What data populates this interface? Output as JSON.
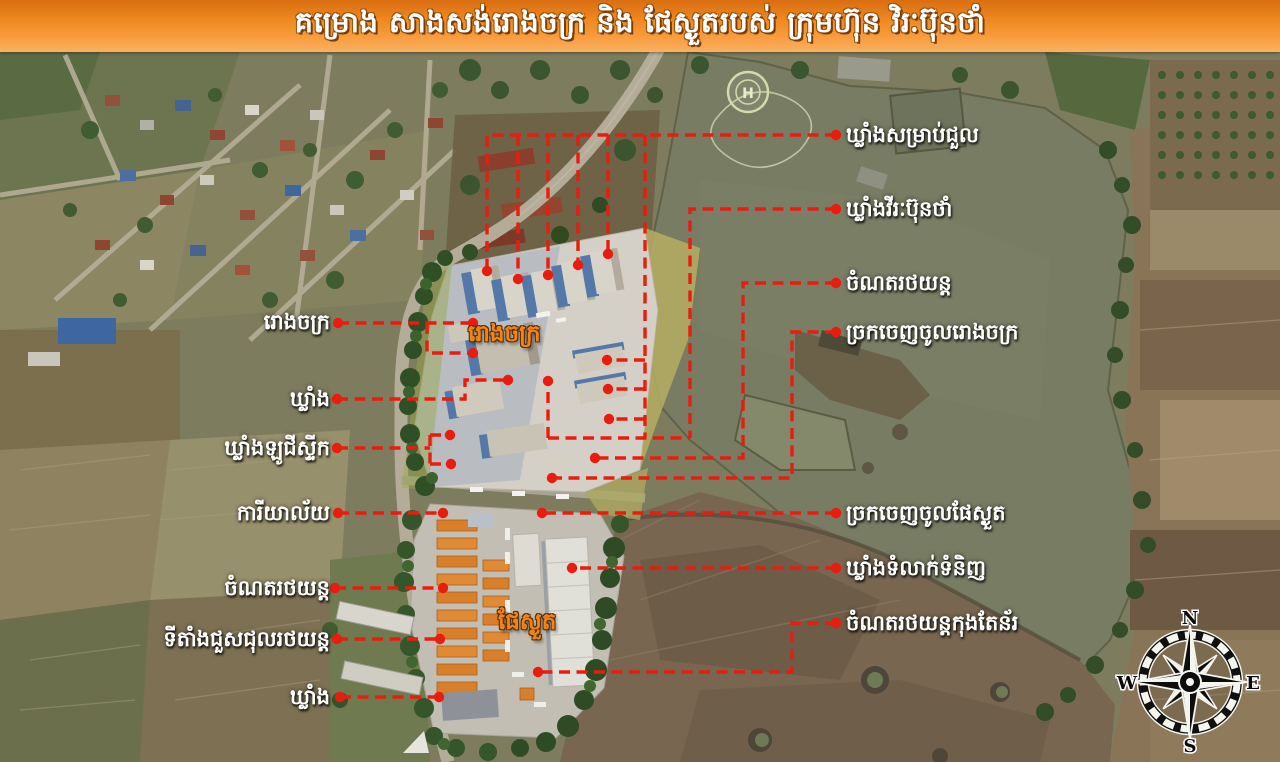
{
  "header": {
    "title": "គម្រោង សាងសង់រោងចក្រ និង ផែស្ងួតរបស់ ក្រុមហ៊ុន វិរៈប៊ុនថាំ"
  },
  "labels": {
    "right": [
      {
        "text": "ឃ្លាំងសម្រាប់ជួល"
      },
      {
        "text": "ឃ្លាំងវីរៈប៊ុនថាំ"
      },
      {
        "text": "ចំណតរថយន្ត"
      },
      {
        "text": "ច្រកចេញចូលរោងចក្រ"
      },
      {
        "text": "ច្រកចេញចូលផែស្ងួត"
      },
      {
        "text": "ឃ្លាំងទំលាក់ទំនិញ"
      },
      {
        "text": "ចំណតរថយន្តកុងតែន័រ"
      }
    ],
    "left": [
      {
        "text": "រោងចក្រ"
      },
      {
        "text": "ឃ្លាំង"
      },
      {
        "text": "ឃ្លាំងឡូជីស្ទីក"
      },
      {
        "text": "ការីយាល័យ"
      },
      {
        "text": "ចំណតរថយន្ត"
      },
      {
        "text": "ទីតាំងជួសជុលរថយន្ត"
      },
      {
        "text": "ឃ្លាំង"
      }
    ],
    "onmap": [
      {
        "text": "រោងចក្រ"
      },
      {
        "text": "ផែស្ងួត"
      }
    ]
  },
  "compass": {
    "north": "N",
    "east": "E",
    "south": "S",
    "west": "W"
  },
  "map_features": {
    "helipad_letter": "H"
  },
  "colors": {
    "annotation_red": "#ea1c0d",
    "banner_orange": "#ef8a20",
    "onmap_label_orange": "#ee8519",
    "lake_green": "#777c63"
  }
}
